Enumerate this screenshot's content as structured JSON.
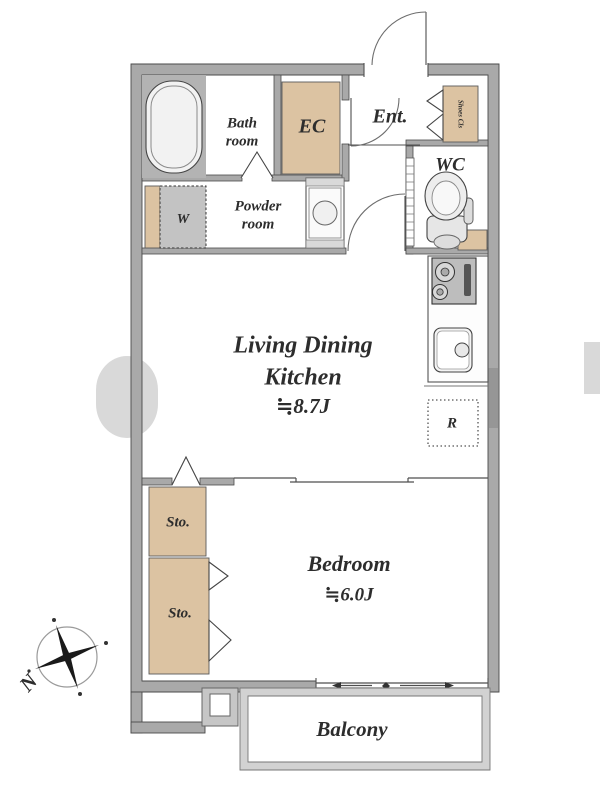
{
  "plan": {
    "bathroom": {
      "line1": "Bath",
      "line2": "room"
    },
    "ec_label": "EC",
    "entrance_label": "Ent.",
    "shoe_closet_label": "Shoes Cls",
    "wc_label": "WC",
    "washer_label": "W",
    "powder": {
      "line1": "Powder",
      "line2": "room"
    },
    "ldk": {
      "line1": "Living Dining",
      "line2": "Kitchen",
      "area": "≒8.7J"
    },
    "fridge_label": "R",
    "storage1_label": "Sto.",
    "storage2_label": "Sto.",
    "bedroom": {
      "name": "Bedroom",
      "area": "≒6.0J"
    },
    "balcony_label": "Balcony",
    "compass_north_label": "N"
  },
  "colors": {
    "wall": "#a9a9a9",
    "outline": "#4a4a4a",
    "accent_beige": "#dcc3a2",
    "bath_tile": "#b3b3b3",
    "appliance_gray": "#c3c3c3",
    "text": "#2d2d2d"
  }
}
